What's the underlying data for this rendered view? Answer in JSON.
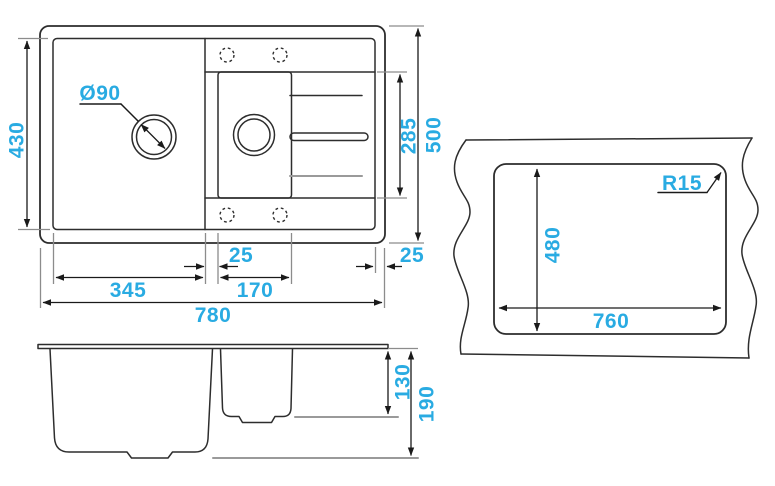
{
  "drawing": {
    "accent_color": "#29ABE2",
    "line_color": "#2d2d2d",
    "plan_view": {
      "inner_depth": "430",
      "overall_depth": "500",
      "drainer_length": "285",
      "drain_diameter": "Ø90",
      "rim_gap_left": "25",
      "main_bowl_width": "345",
      "second_bowl_width": "170",
      "rim_gap_right": "25",
      "overall_width": "780"
    },
    "side_view": {
      "second_bowl_depth": "130",
      "main_bowl_depth": "190"
    },
    "cutout_view": {
      "cutout_height": "480",
      "cutout_width": "760",
      "corner_radius": "R15"
    }
  }
}
